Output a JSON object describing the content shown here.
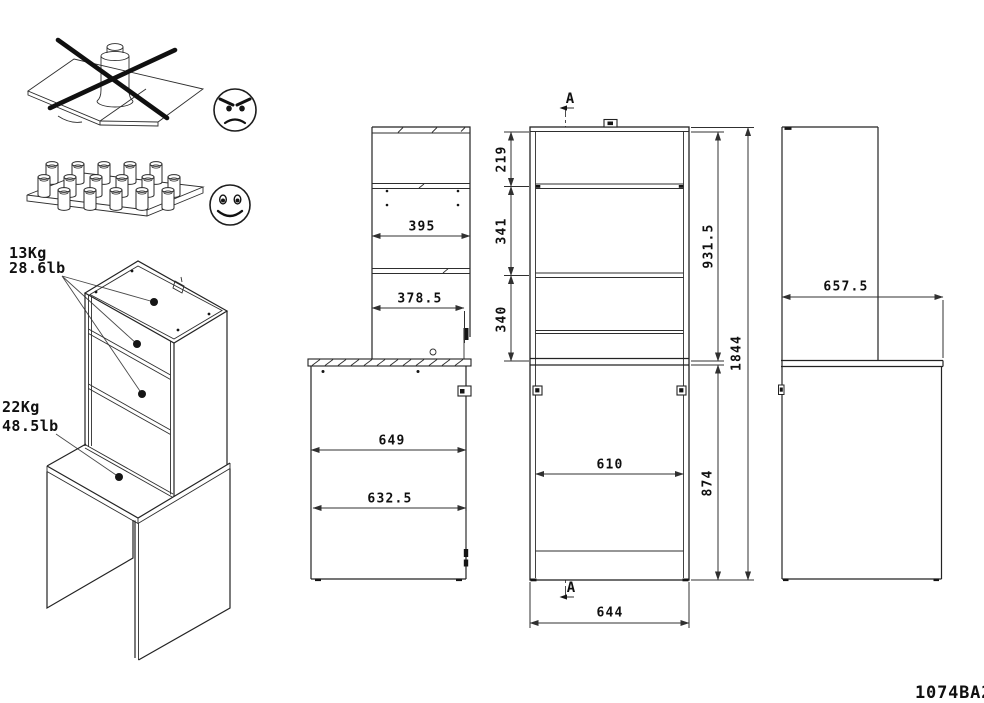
{
  "drawing": {
    "part_number": "1074BA2",
    "load_labels": {
      "shelf_kg": "13Kg",
      "shelf_lb": "28.6lb",
      "desktop_kg": "22Kg",
      "desktop_lb": "48.5lb"
    },
    "side_view": {
      "shelf_depth": "395",
      "lower_shelf_depth": "378.5",
      "desk_depth_outer": "649",
      "desk_depth_inner": "632.5"
    },
    "front_view": {
      "section_label_top": "A",
      "section_label_bottom": "A",
      "top_shelf_gap": "219",
      "middle_shelf_gap": "341",
      "lower_shelf_gap": "340",
      "hutch_height": "931.5",
      "desk_height": "874",
      "total_height": "1844",
      "inner_width": "610",
      "outer_width": "644"
    },
    "right_view": {
      "desk_depth": "657.5"
    },
    "icons": {
      "bad_loading": "concentrated-load-crossed-out",
      "good_loading": "distributed-load",
      "bad_face": "angry-face",
      "good_face": "happy-face"
    },
    "colors": {
      "line": "#232323",
      "background": "#ffffff"
    }
  }
}
